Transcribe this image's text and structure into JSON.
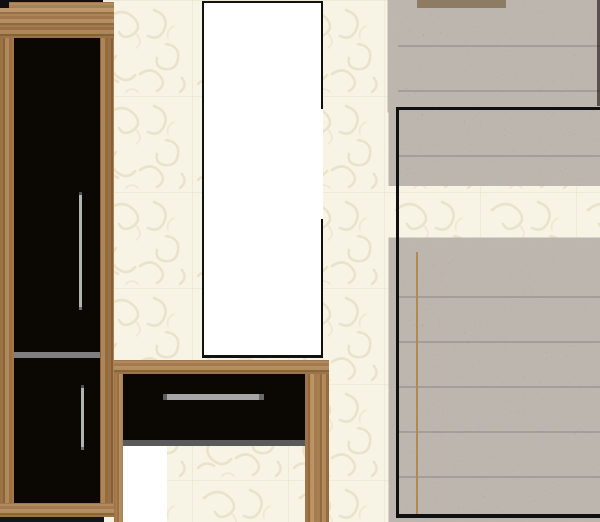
{
  "scene": {
    "type": "furniture-collage",
    "description": "Hallway furniture set arranged on cream floral wallpaper",
    "palette": {
      "wallpaper": "#f7f4e6",
      "wallpaper_motif": "#e8e0c4",
      "wood": "#a87c4a",
      "wood_dark": "#85592c",
      "door_black": "#0b0804",
      "handle_silver": "#a8a8a8",
      "divider_gray": "#7f7f7f",
      "drawer_shadow_gray": "#5a5a5a",
      "panel_gray_base": "#55514a",
      "panel_gray_speckle": "#7d7971",
      "outline_black": "#101010",
      "tan_accent": "#b3894e",
      "tan_strip": "#8d7c63",
      "white": "#ffffff",
      "floor_white": "#ffffff",
      "shadow": "#151515"
    },
    "items": [
      {
        "id": "tall-cabinet",
        "kind": "wardrobe",
        "finish": "oak frame, black gloss doors, silver handles"
      },
      {
        "id": "white-panel",
        "kind": "mirror-panel",
        "finish": "white with thin black frame"
      },
      {
        "id": "console-table",
        "kind": "console",
        "finish": "oak frame, black drawer, silver handle"
      },
      {
        "id": "gray-wardrobe-top",
        "kind": "wardrobe-section",
        "finish": "gray speckled fabric texture"
      },
      {
        "id": "gray-wardrobe-front",
        "kind": "wardrobe-section",
        "finish": "gray speckled fabric, black outline, tan trim"
      }
    ]
  }
}
